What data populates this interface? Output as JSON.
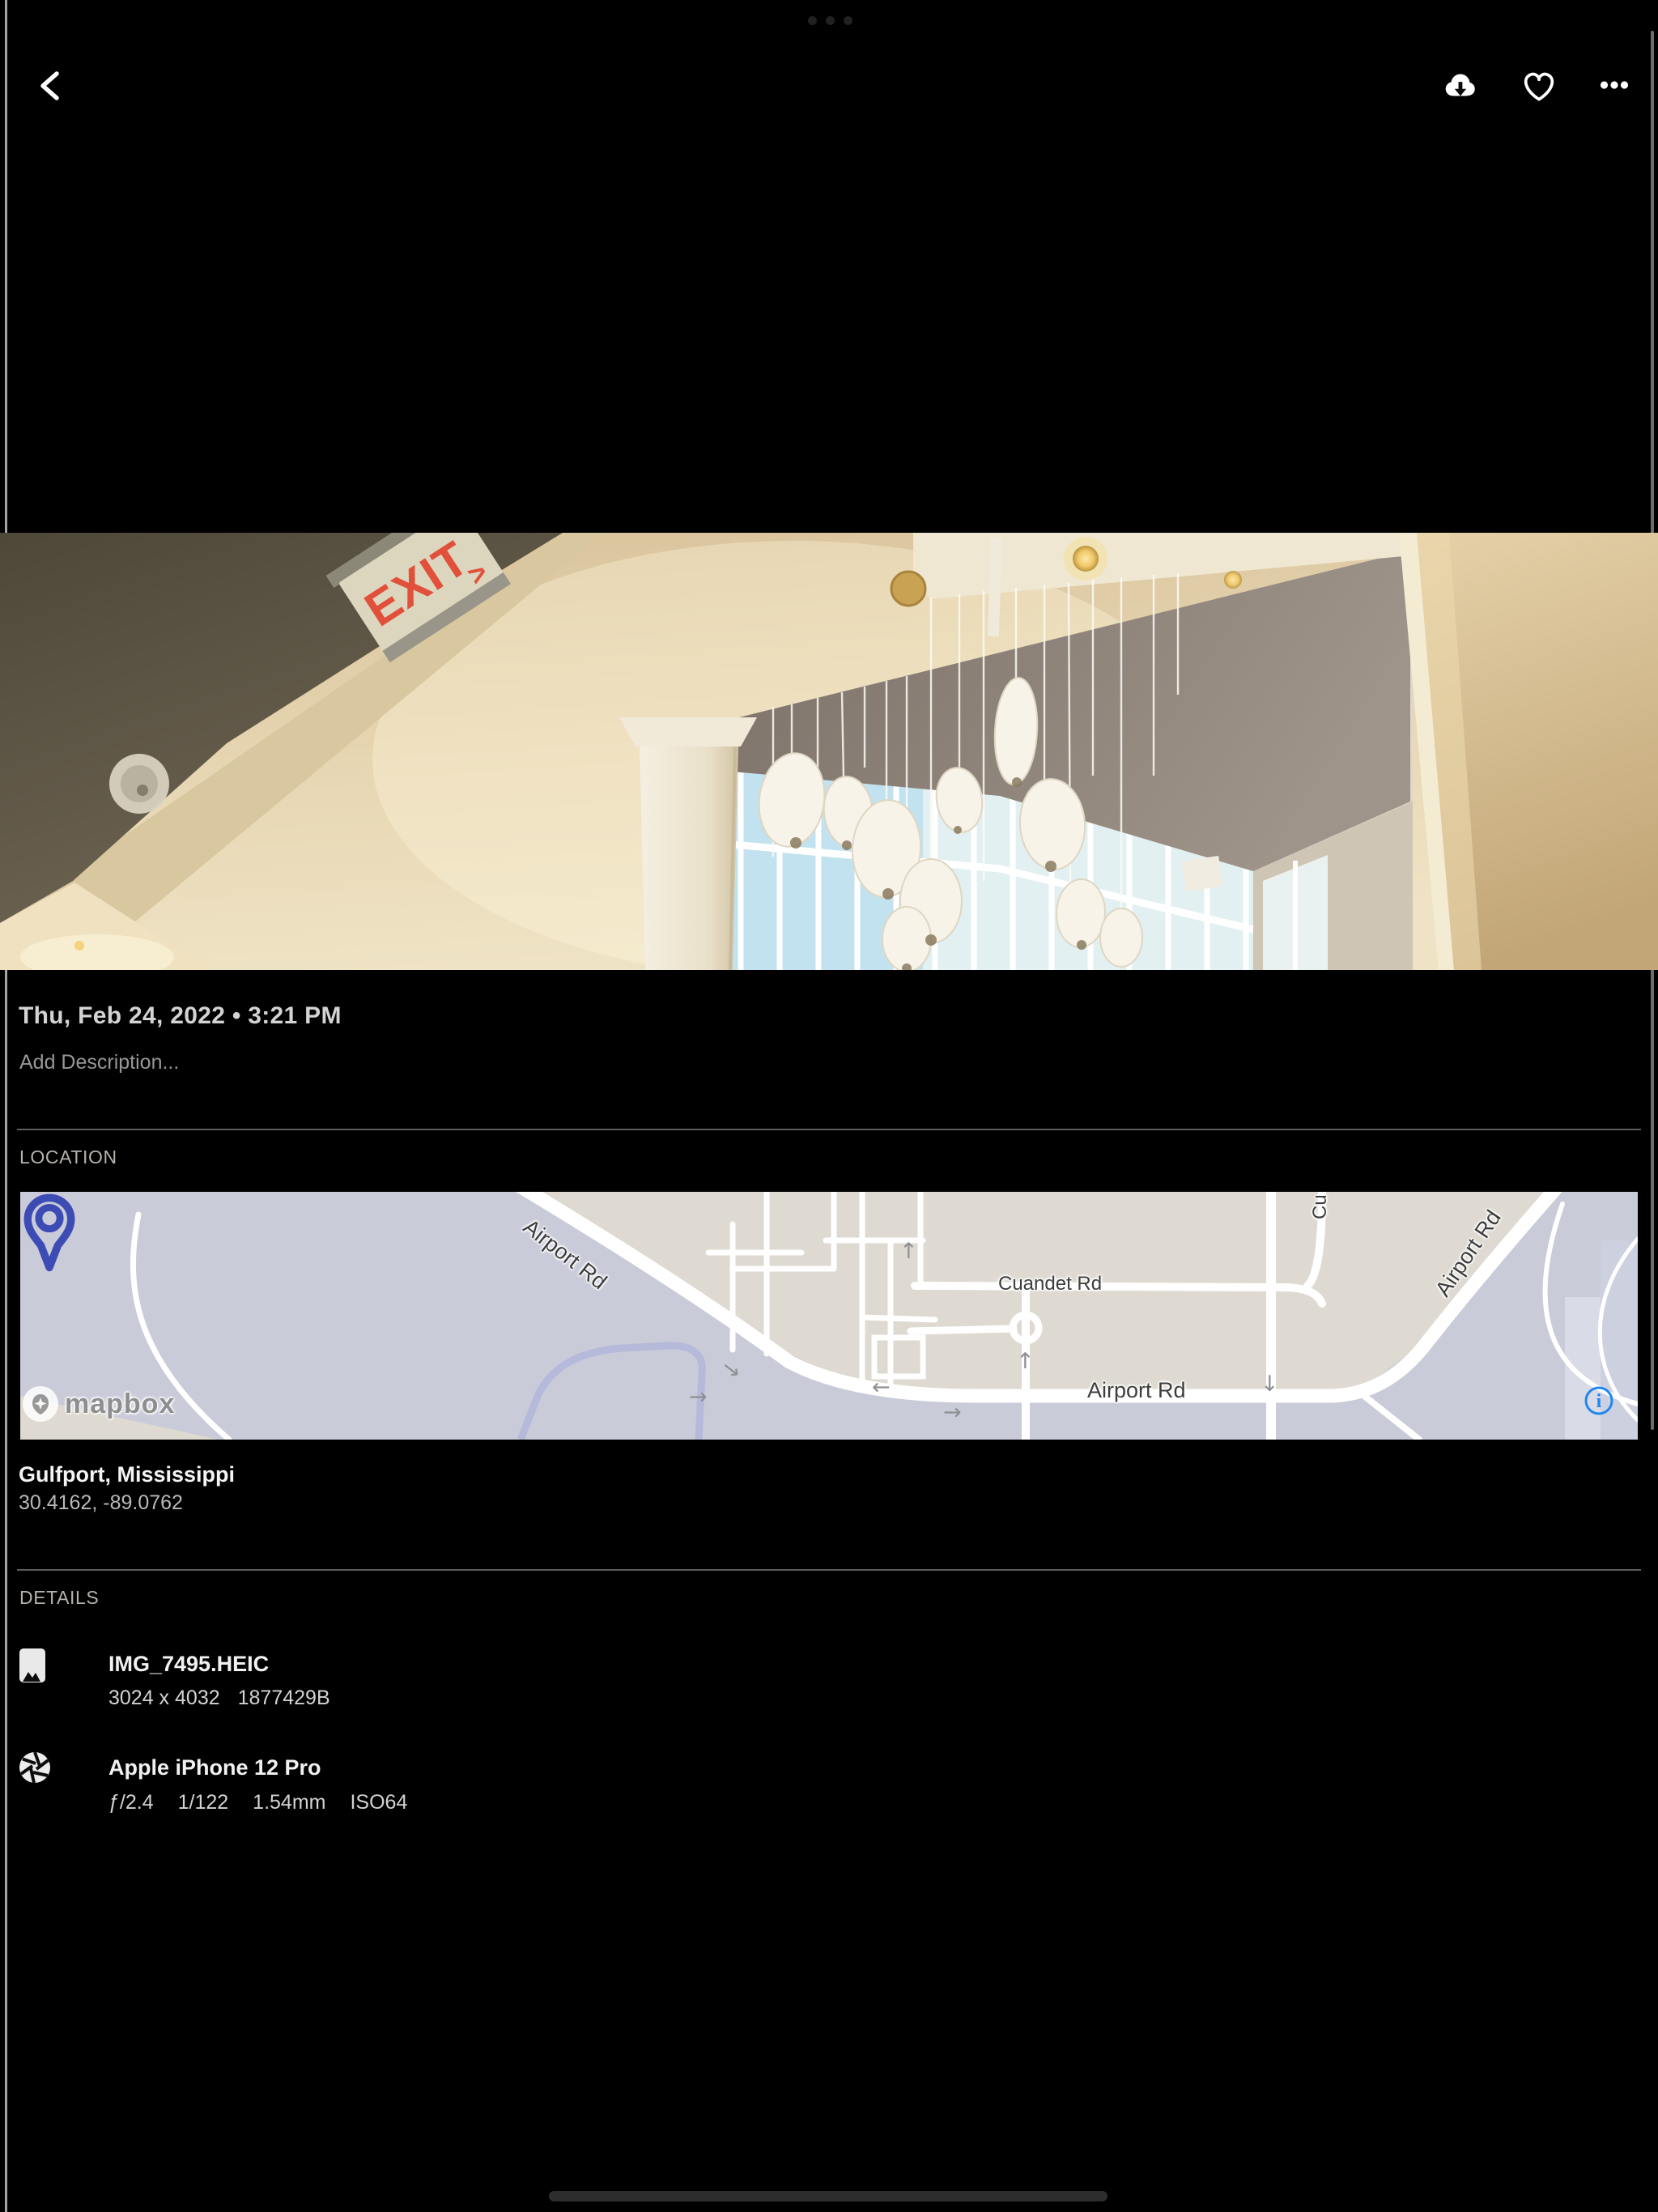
{
  "icons": {
    "back": "chevron-left",
    "download": "cloud-download",
    "favorite": "heart-outline",
    "more": "ellipsis-horizontal",
    "multitask": "multitask-dots",
    "home": "home-indicator",
    "file": "image-icon",
    "camera": "aperture-icon",
    "map_pin": "map-pin",
    "map_info": "info-circle",
    "mapbox_logo": "mapbox-pin-star"
  },
  "colors": {
    "pin_blue": "#3C4CB4",
    "info_blue": "#1E87F2",
    "exit_red": "#E05840"
  },
  "photo": {
    "exit_sign_text": "EXIT",
    "exit_sign_arrow": ">"
  },
  "metadata": {
    "date_line": "Thu, Feb 24, 2022 • 3:21 PM",
    "description_placeholder": "Add Description..."
  },
  "location": {
    "section_label": "LOCATION",
    "place": "Gulfport, Mississippi",
    "coordinates": "30.4162, -89.0762",
    "map": {
      "attribution": "mapbox",
      "labels": [
        {
          "text": "Airport Rd"
        },
        {
          "text": "Cuandet Rd"
        },
        {
          "text": "Airport Rd"
        },
        {
          "text": "Airport Rd"
        },
        {
          "text": "Cu"
        }
      ]
    }
  },
  "details": {
    "section_label": "DETAILS",
    "file": {
      "name": "IMG_7495.HEIC",
      "dimensions": "3024 x 4032",
      "size": "1877429B"
    },
    "camera": {
      "name": "Apple iPhone 12 Pro",
      "aperture": "ƒ/2.4",
      "shutter": "1/122",
      "focal_length": "1.54mm",
      "iso": "ISO64"
    }
  }
}
